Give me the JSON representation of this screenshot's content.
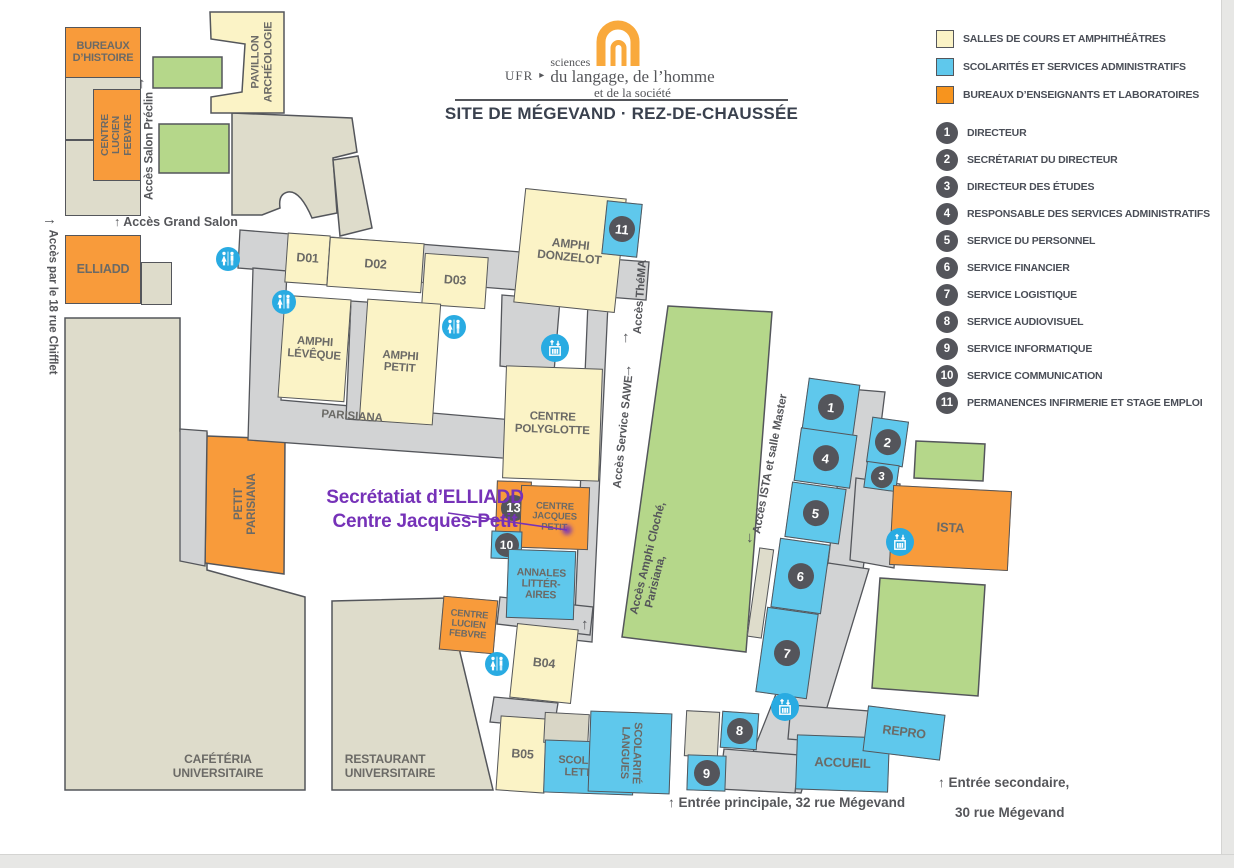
{
  "header": {
    "ufr_label": "UFR",
    "ufr_arrow": "▸",
    "logo_line1": "sciences",
    "logo_line2": "du langage, de l’homme",
    "logo_line3": "et de la société",
    "title": "SITE DE MÉGEVAND · REZ-DE-CHAUSSÉE"
  },
  "colors": {
    "cream_rooms": "#FBF3C6",
    "blue_rooms": "#5FC8EC",
    "orange_rooms": "#F89B3B",
    "legend_orange": "#F7941E",
    "green_areas": "#B5D78A",
    "beige_buildings": "#DEDCCB",
    "corridor_gray": "#D2D3D4",
    "badge_gray": "#54555B",
    "icon_blue": "#29ABE2",
    "annotation_purple": "#7632B8"
  },
  "legend": {
    "items": [
      {
        "label": "SALLES DE COURS ET AMPHITHÉÂTRES",
        "color": "#FBF3C6"
      },
      {
        "label": "SCOLARITÉS ET SERVICES ADMINISTRATIFS",
        "color": "#5FC8EC"
      },
      {
        "label": "BUREAUX D’ENSEIGNANTS ET LABORATOIRES",
        "color": "#F7941E"
      }
    ]
  },
  "directory": [
    {
      "num": "1",
      "label": "DIRECTEUR"
    },
    {
      "num": "2",
      "label": "SECRÉTARIAT DU DIRECTEUR"
    },
    {
      "num": "3",
      "label": "DIRECTEUR DES ÉTUDES"
    },
    {
      "num": "4",
      "label": "RESPONSABLE DES SERVICES ADMINISTRATIFS"
    },
    {
      "num": "5",
      "label": "SERVICE DU PERSONNEL"
    },
    {
      "num": "6",
      "label": "SERVICE FINANCIER"
    },
    {
      "num": "7",
      "label": "SERVICE LOGISTIQUE"
    },
    {
      "num": "8",
      "label": "SERVICE AUDIOVISUEL"
    },
    {
      "num": "9",
      "label": "SERVICE INFORMATIQUE"
    },
    {
      "num": "10",
      "label": "SERVICE COMMUNICATION"
    },
    {
      "num": "11",
      "label": "PERMANENCES INFIRMERIE ET STAGE EMPLOI"
    }
  ],
  "rooms": {
    "bureaux_histoire": "BUREAUX\nD’HISTOIRE",
    "centre_lucien_febvre": "CENTRE\nLUCIEN\nFEBVRE",
    "pavillon_archeologie": "PAVILLON\nARCHÉOLOGIE",
    "elliadd": "ELLIADD",
    "d01": "D01",
    "d02": "D02",
    "d03": "D03",
    "amphi_donzelot": "AMPHI\nDONZELOT",
    "amphi_leveque": "AMPHI\nLÉVÊQUE",
    "amphi_petit": "AMPHI\nPETIT",
    "parisiana": "PARISIANA",
    "centre_polyglotte": "CENTRE\nPOLYGLOTTE",
    "petit_parisiana": "PETIT\nPARISIANA",
    "centre_jacques_petit": "CENTRE\nJACQUES\nPETIT",
    "annales_litteraires": "ANNALES\nLITTÉR-\nAIRES",
    "b04": "B04",
    "b05": "B05",
    "cafeteria": "CAFÉTÉRIA\nUNIVERSITAIRE",
    "restaurant": "RESTAURANT\nUNIVERSITAIRE",
    "scolarite_lettres": "SCOLARITÉ\nLETTRES",
    "scolarite_langues": "SCOLARITÉ\nLANGUES",
    "accueil": "ACCUEIL",
    "repro": "REPRO",
    "ista": "ISTA"
  },
  "map_badges": {
    "donzelot": "11",
    "cjp13": "13",
    "cjp10": "10",
    "r1": "1",
    "r2": "2",
    "r3": "3",
    "r4": "4",
    "r5": "5",
    "r6": "6",
    "r7": "7",
    "r8": "8",
    "r9": "9"
  },
  "access": {
    "grand_salon": "↑ Accès Grand Salon",
    "salon_preclin": {
      "arrow": "↑",
      "text": "Accès Salon Préclin"
    },
    "chifflet": {
      "arrow": "→",
      "text": "Accès par le 18 rue Chifflet"
    },
    "thema": {
      "arrow": "↑",
      "text": "Accès ThéMA"
    },
    "sawe": {
      "arrow": "↑",
      "text": "Accès Service SAWE"
    },
    "amphi_cloche": {
      "arrow": "↑",
      "line1": "Accès Amphi Cloché,",
      "line2": "Parisiana,"
    },
    "ista_master": {
      "arrow": "↓",
      "text": "Accès ISTA et salle Master"
    },
    "entree_principale": "↑ Entrée principale, 32 rue Mégevand",
    "entree_secondaire_line1": "↑ Entrée secondaire,",
    "entree_secondaire_line2": "30 rue Mégevand"
  },
  "annotation": {
    "line1": "Secrétatiat d’ELLIADD",
    "line2": "Centre Jacques-Petit"
  },
  "icons": {
    "wc": "restrooms",
    "elevator": "elevator"
  }
}
